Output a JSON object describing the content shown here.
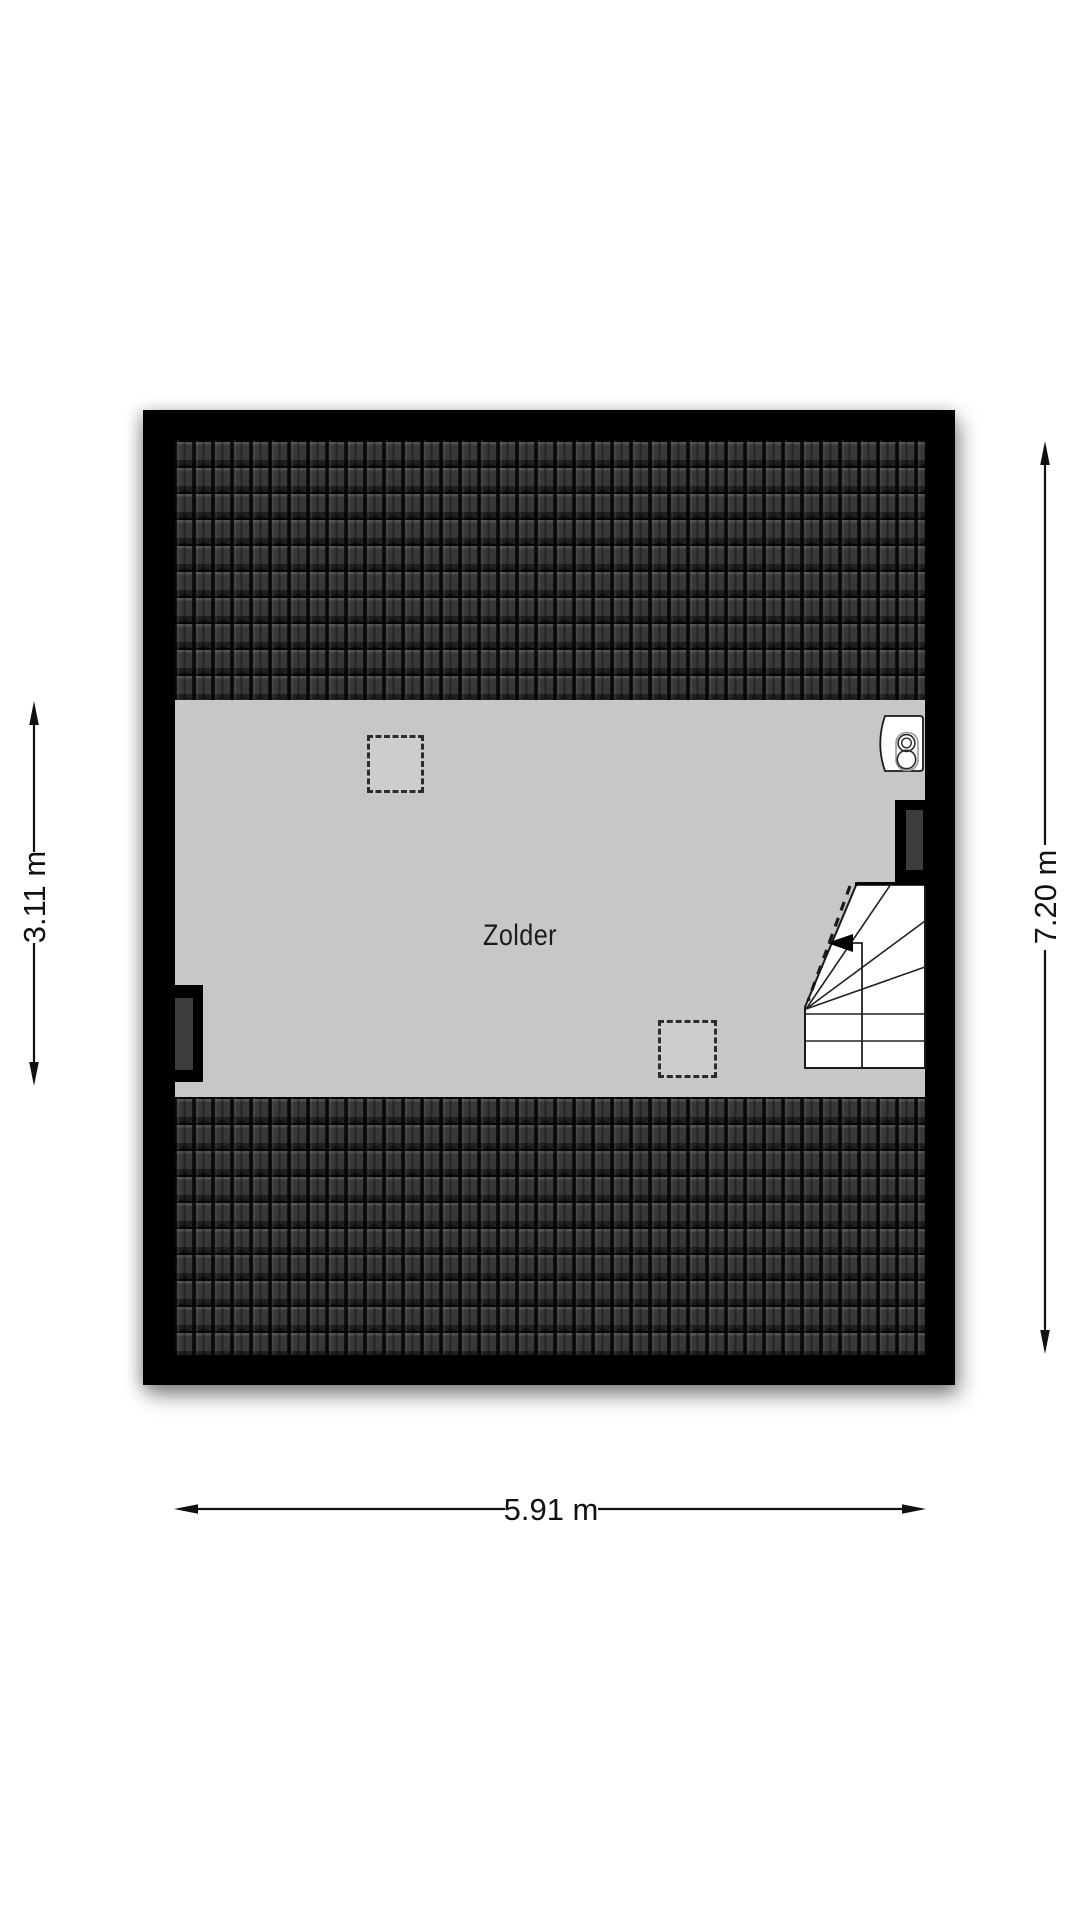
{
  "plan": {
    "type": "floorplan",
    "room": {
      "label": "Zolder"
    },
    "dimensions": {
      "left": "3.11 m",
      "right": "7.20 m",
      "bottom": "5.91 m"
    },
    "elements": {
      "roof_top": "roof-tiles-band",
      "roof_bottom": "roof-tiles-band",
      "skylight_1": "dashed-skylight-marker",
      "skylight_2": "dashed-skylight-marker",
      "window_left": "dormer-window-marker",
      "window_right": "dormer-window-marker",
      "boiler": "boiler-icon",
      "stairs": "winder-staircase-with-direction-arrow"
    },
    "colors": {
      "wall": "#000000",
      "floor": "#c7c7c7",
      "roof_tiles": "#383838",
      "paper": "#ffffff",
      "dimension_text": "#111111"
    }
  }
}
